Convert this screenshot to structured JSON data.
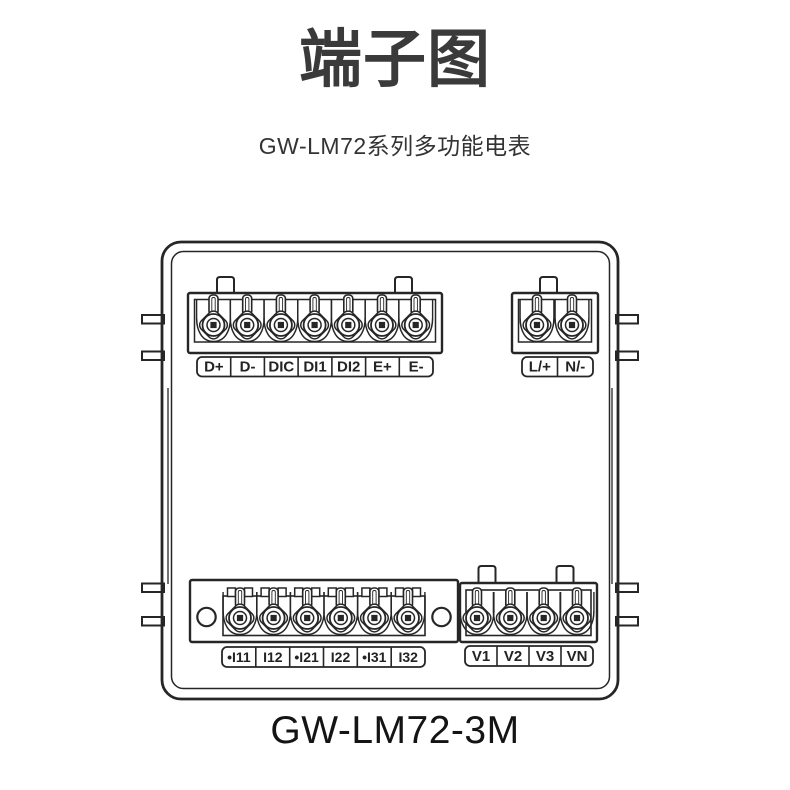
{
  "page": {
    "title": "端子图",
    "subtitle": "GW-LM72系列多功能电表",
    "model_label": "GW-LM72-3M"
  },
  "colors": {
    "background": "#ffffff",
    "line": "#262626",
    "title_text": "#3a3a3a",
    "subtitle_text": "#333333",
    "model_text": "#141414",
    "label_text": "#232323"
  },
  "diagram": {
    "description": "terminal-wiring-diagram",
    "terminal_groups": [
      {
        "id": "top-left-comm-di",
        "labels": [
          "D+",
          "D-",
          "DIC",
          "DI1",
          "DI2",
          "E+",
          "E-"
        ]
      },
      {
        "id": "top-right-power",
        "labels": [
          "L/+",
          "N/-"
        ]
      },
      {
        "id": "bottom-left-current",
        "labels": [
          "•I11",
          "I12",
          "•I21",
          "I22",
          "•I31",
          "I32"
        ]
      },
      {
        "id": "bottom-right-voltage",
        "labels": [
          "V1",
          "V2",
          "V3",
          "VN"
        ]
      }
    ]
  }
}
